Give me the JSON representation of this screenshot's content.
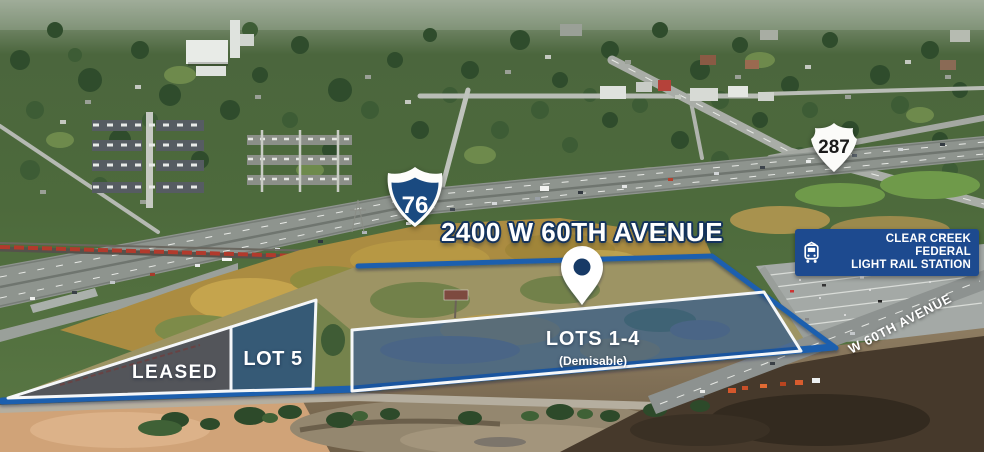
{
  "title": "2400 W 60TH AVENUE",
  "shields": {
    "interstate": "76",
    "us_route": "287"
  },
  "station": {
    "line1": "CLEAR CREEK FEDERAL",
    "line2": "LIGHT RAIL STATION"
  },
  "lots": {
    "leased": "LEASED",
    "lot5": "LOT 5",
    "lots_1_4": "LOTS 1-4",
    "lots_1_4_note": "(Demisable)"
  },
  "street": "W 60TH AVENUE",
  "icons": {
    "pin": "location-pin-icon",
    "train": "light-rail-train-icon"
  },
  "colors": {
    "overlay_navy": "#1d4a8f",
    "boundary_blue": "#1f5fae",
    "lot_fill_blue": "#1e4f97",
    "leased_fill_gray": "#3c4450",
    "interstate_shield_blue": "#1a4a80",
    "title_outline_navy": "#14335c",
    "text_white": "#ffffff"
  }
}
